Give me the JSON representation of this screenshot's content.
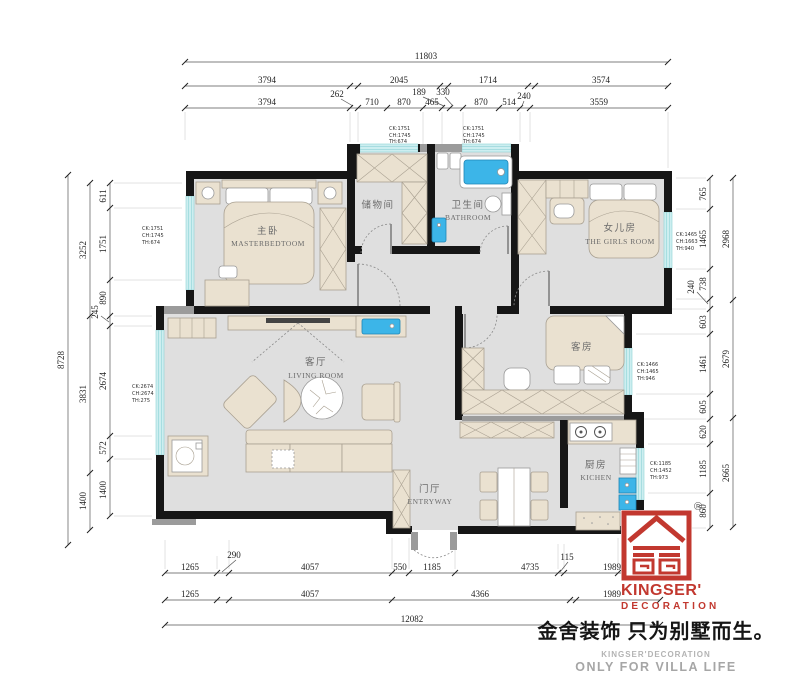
{
  "rooms": {
    "master": {
      "zh": "主卧",
      "en": "MASTERBEDTOOM"
    },
    "storage": {
      "zh": "储物间"
    },
    "bathroom": {
      "zh": "卫生间",
      "en": "BATHROOM"
    },
    "girls": {
      "zh": "女儿房",
      "en": "THE GIRLS ROOM"
    },
    "living": {
      "zh": "客厅",
      "en": "LIVING ROOM"
    },
    "guest": {
      "zh": "客房"
    },
    "kitchen": {
      "zh": "厨房",
      "en": "KICHEN"
    },
    "entry": {
      "zh": "门厅",
      "en": "ENTRYWAY"
    }
  },
  "windows": {
    "master_left": [
      "CK:1751",
      "CH:1745",
      "TH:674"
    ],
    "storage_top": [
      "CK:1751",
      "CH:1745",
      "TH:674"
    ],
    "bath_top": [
      "CK:1751",
      "CH:1745",
      "TH:674"
    ],
    "girls_right": [
      "CK:1465",
      "CH:1663",
      "TH:940"
    ],
    "guest_right": [
      "CK:1466",
      "CH:1465",
      "TH:946"
    ],
    "kitchen_right": [
      "CK:1185",
      "CH:1452",
      "TH:973"
    ],
    "living_left": [
      "CK:2674",
      "CH:2674",
      "TH:275"
    ]
  },
  "dims": {
    "top1": [
      "11803"
    ],
    "top2": [
      "3794",
      "2045",
      "1714",
      "3574"
    ],
    "top2b": [
      "262"
    ],
    "top3": [
      "3794",
      "710",
      "870",
      "465",
      "870",
      "514",
      "3559"
    ],
    "top3b": [
      "189",
      "330",
      "240"
    ],
    "left_outer": [
      "8728"
    ],
    "left_mid": [
      "3252",
      "3831",
      "1400"
    ],
    "left_inner": [
      "611",
      "1751",
      "890",
      "245",
      "2674",
      "572",
      "1400"
    ],
    "right_inner": [
      "765",
      "1465",
      "738",
      "240",
      "603",
      "1461",
      "605",
      "620",
      "1185",
      "860"
    ],
    "right_outer": [
      "2968",
      "2679",
      "2665"
    ],
    "bottom1": [
      "1265",
      "290",
      "4057",
      "550",
      "1185",
      "4735",
      "115",
      "1989"
    ],
    "bottom2": [
      "1265",
      "4057",
      "4366",
      "1989"
    ],
    "bottom3": [
      "12082"
    ]
  },
  "logo": {
    "registered": "®",
    "brand": "KINGSER'",
    "brand_sub": "DECORATION",
    "tagline_zh": "金舍装饰 只为别墅而生。",
    "tagline_en1": "KINGSER'DECORATION",
    "tagline_en2": "ONLY FOR VILLA LIFE"
  },
  "colors": {
    "wall": "#161616",
    "floor": "#dfdfdf",
    "furniture": "#eae1d0",
    "window": "#cdeef0",
    "water": "#3cb5e8",
    "brand_red": "#c2382f"
  }
}
